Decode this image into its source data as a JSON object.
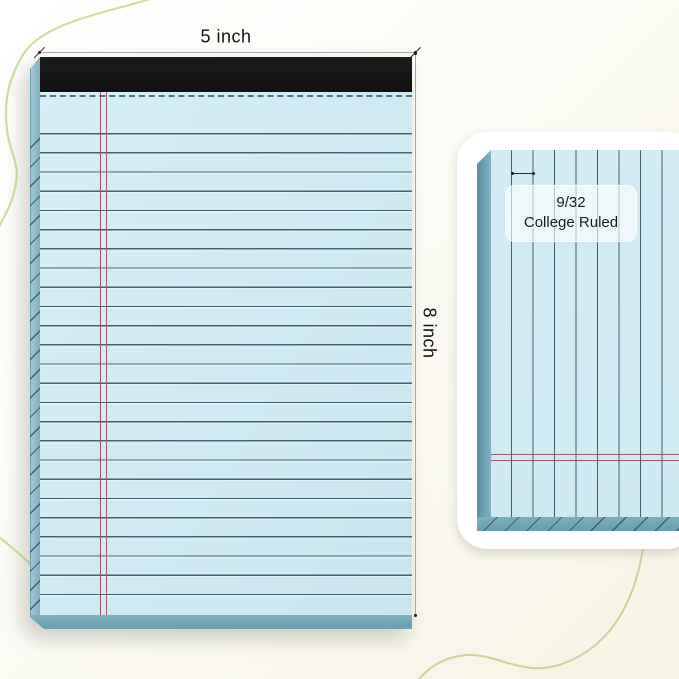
{
  "annotations": {
    "width": {
      "label": "5 inch"
    },
    "height": {
      "label": "8 inch"
    },
    "ruling": {
      "value": "9/32",
      "name": "College Ruled"
    }
  },
  "colors": {
    "paper_blue": "#cfeaf3",
    "pad_edge_blue": "#7aadbf",
    "binding_black": "#141414",
    "rule_line": "#41636f",
    "margin_red": "#a0526a",
    "background_cream": "#f7f4e5",
    "accent_green": "#cfe09c",
    "card_white": "#ffffff",
    "annotation_gray": "#a6a6a6"
  }
}
